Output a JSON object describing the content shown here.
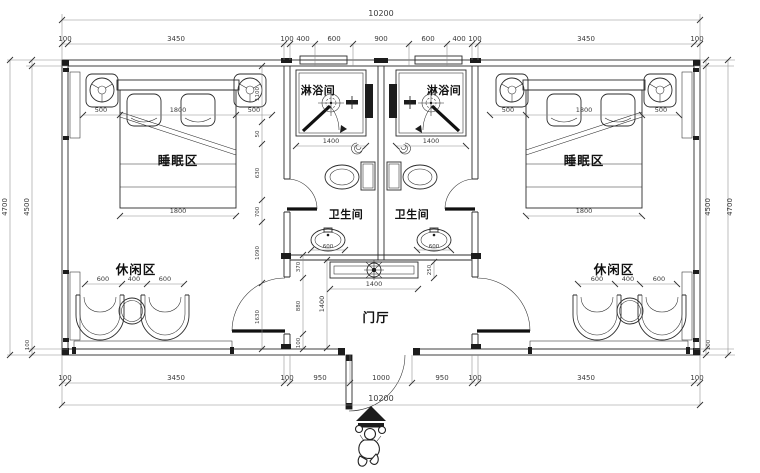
{
  "rooms": {
    "sleeping_left": "睡眠区",
    "sleeping_right": "睡眠区",
    "shower_left": "淋浴间",
    "shower_right": "淋浴间",
    "toilet_left": "卫生间",
    "toilet_right": "卫生间",
    "leisure_left": "休闲区",
    "leisure_right": "休闲区",
    "foyer": "门厅"
  },
  "dimensions": {
    "top_total": "10200",
    "top_row": [
      "100",
      "3450",
      "100",
      "400",
      "600",
      "900",
      "600",
      "400",
      "100",
      "3450",
      "100"
    ],
    "bottom_row": [
      "100",
      "3450",
      "100",
      "950",
      "1000",
      "950",
      "100",
      "3450",
      "100"
    ],
    "bottom_total": "10200",
    "left_outer": "4700",
    "left_inner": "4500",
    "left_inner_bottom": "100",
    "right_inner": "4500",
    "right_outer": "4700",
    "right_inner_bottom": "100",
    "bed_row": [
      "500",
      "1800",
      "500"
    ],
    "bed_width": "1800",
    "left_chain": [
      "1100",
      "50",
      "630",
      "700",
      "1090",
      "1630"
    ],
    "shower_width": "1400",
    "sink_width": "600",
    "counter_width": "1400",
    "counter_depth": "250",
    "counter_offset": "370",
    "foyer_height": "1400",
    "foyer_lower": "880",
    "wall_thickness": "100",
    "leisure_row": [
      "600",
      "400",
      "600"
    ]
  }
}
